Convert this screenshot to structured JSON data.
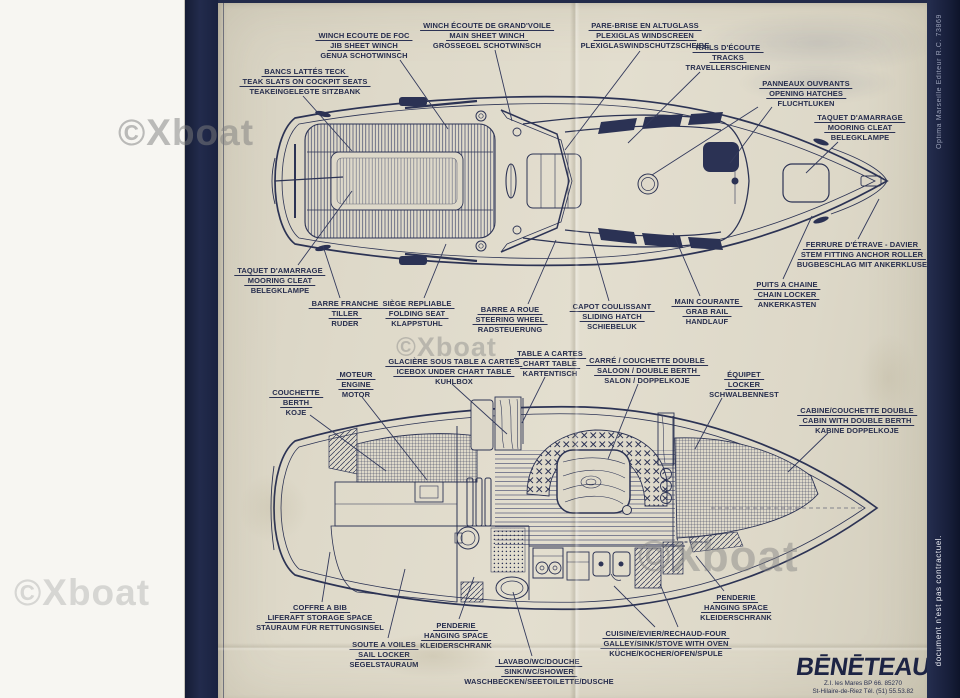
{
  "watermark": {
    "text": "©Xboat"
  },
  "edge": {
    "printer_credit": "Optima Marseille Editeur R.C. 73869",
    "disclaimer": "document n'est pas contractuel."
  },
  "logo": {
    "name": "BĒNĒTEAU",
    "address_line1": "Z.I. les Mares BP 66. 85270",
    "address_line2": "St-Hilaire-de-Riez Tél. (51) 55.53.82"
  },
  "deck_plan": {
    "callouts": [
      {
        "id": "jib-sheet-winch",
        "cx": 364,
        "top": 28,
        "fr": "WINCH ECOUTE DE FOC",
        "en": "JIB SHEET WINCH",
        "de": "GENUA SCHOTWINSCH",
        "leaders": [
          [
            400,
            57,
            448,
            126
          ]
        ]
      },
      {
        "id": "main-sheet-winch",
        "cx": 487,
        "top": 18,
        "fr": "WINCH ÉCOUTE DE GRAND'VOILE",
        "en": "MAIN SHEET WINCH",
        "de": "GROSSEGEL SCHOTWINSCH",
        "leaders": [
          [
            495,
            47,
            512,
            118
          ]
        ]
      },
      {
        "id": "windscreen",
        "cx": 645,
        "top": 18,
        "fr": "PARE-BRISE EN ALTUGLASS",
        "en": "PLEXIGLAS WINDSCREEN",
        "de": "PLEXIGLASWINDSCHUTZSCHEIBE",
        "leaders": [
          [
            640,
            48,
            565,
            147
          ]
        ]
      },
      {
        "id": "tracks",
        "cx": 728,
        "top": 40,
        "fr": "RAILS D'ÉCOUTE",
        "en": "TRACKS",
        "de": "TRAVELLERSCHIENEN",
        "leaders": [
          [
            700,
            69,
            628,
            140
          ]
        ]
      },
      {
        "id": "teak-slats",
        "cx": 305,
        "top": 64,
        "fr": "BANCS LATTÉS TECK",
        "en": "TEAK SLATS ON COCKPIT SEATS",
        "de": "TEAKEINGELEGTE SITZBANK",
        "leaders": [
          [
            303,
            93,
            352,
            148
          ]
        ]
      },
      {
        "id": "opening-hatches",
        "cx": 806,
        "top": 76,
        "fr": "PANNEAUX OUVRANTS",
        "en": "OPENING HATCHES",
        "de": "FLUCHTLUKEN",
        "leaders": [
          [
            772,
            104,
            730,
            160
          ],
          [
            758,
            104,
            652,
            172
          ]
        ]
      },
      {
        "id": "mooring-cleat-fwd",
        "cx": 860,
        "top": 110,
        "fr": "TAQUET D'AMARRAGE",
        "en": "MOORING CLEAT",
        "de": "BELEGKLAMPE",
        "leaders": [
          [
            838,
            139,
            806,
            170
          ]
        ]
      },
      {
        "id": "stem-fitting",
        "cx": 862,
        "top": 237,
        "fr": "FERRURE D'ÉTRAVE - DAVIER",
        "en": "STEM FITTING ANCHOR ROLLER",
        "de": "BUGBESCHLAG MIT ANKERKLUSE",
        "leaders": [
          [
            858,
            236,
            879,
            196
          ]
        ]
      },
      {
        "id": "chain-locker",
        "cx": 787,
        "top": 277,
        "fr": "PUITS A CHAINE",
        "en": "CHAIN LOCKER",
        "de": "ANKERKASTEN",
        "leaders": [
          [
            783,
            276,
            812,
            213
          ]
        ]
      },
      {
        "id": "grab-rail",
        "cx": 707,
        "top": 294,
        "fr": "MAIN COURANTE",
        "en": "GRAB RAIL",
        "de": "HANDLAUF",
        "leaders": [
          [
            700,
            293,
            673,
            230
          ]
        ]
      },
      {
        "id": "sliding-hatch",
        "cx": 612,
        "top": 299,
        "fr": "CAPOT COULISSANT",
        "en": "SLIDING HATCH",
        "de": "SCHIEBELUK",
        "leaders": [
          [
            609,
            298,
            589,
            230
          ]
        ]
      },
      {
        "id": "steering-wheel",
        "cx": 510,
        "top": 302,
        "fr": "BARRE A ROUE",
        "en": "STEERING WHEEL",
        "de": "RADSTEUERUNG",
        "leaders": [
          [
            528,
            301,
            556,
            237
          ]
        ]
      },
      {
        "id": "folding-seat",
        "cx": 417,
        "top": 296,
        "fr": "SIÈGE REPLIABLE",
        "en": "FOLDING SEAT",
        "de": "KLAPPSTUHL",
        "leaders": [
          [
            424,
            295,
            446,
            241
          ]
        ]
      },
      {
        "id": "tiller",
        "cx": 345,
        "top": 296,
        "fr": "BARRE FRANCHE",
        "en": "TILLER",
        "de": "RUDER",
        "leaders": [
          [
            340,
            295,
            323,
            243
          ]
        ]
      },
      {
        "id": "mooring-cleat-aft",
        "cx": 280,
        "top": 263,
        "fr": "TAQUET D'AMARRAGE",
        "en": "MOORING CLEAT",
        "de": "BELEGKLAMPE",
        "leaders": [
          [
            298,
            262,
            352,
            188
          ]
        ]
      }
    ]
  },
  "interior_plan": {
    "callouts": [
      {
        "id": "engine",
        "cx": 356,
        "top": 367,
        "fr": "MOTEUR",
        "en": "ENGINE",
        "de": "MOTOR",
        "leaders": [
          [
            362,
            394,
            427,
            477
          ]
        ]
      },
      {
        "id": "icebox",
        "cx": 454,
        "top": 354,
        "fr": "GLACIÈRE SOUS TABLE A CARTES",
        "en": "ICEBOX UNDER CHART TABLE",
        "de": "KUHLBOX",
        "leaders": [
          [
            452,
            381,
            507,
            431
          ]
        ]
      },
      {
        "id": "chart-table",
        "cx": 550,
        "top": 346,
        "fr": "TABLE A CARTES",
        "en": "CHART TABLE",
        "de": "KARTENTISCH",
        "leaders": [
          [
            545,
            374,
            522,
            420
          ]
        ]
      },
      {
        "id": "saloon-double-berth",
        "cx": 647,
        "top": 353,
        "fr": "CARRÉ / COUCHETTE DOUBLE",
        "en": "SALOON / DOUBLE BERTH",
        "de": "SALON / DOPPELKOJE",
        "leaders": [
          [
            638,
            381,
            608,
            456
          ]
        ]
      },
      {
        "id": "berth",
        "cx": 296,
        "top": 385,
        "fr": "COUCHETTE",
        "en": "BERTH",
        "de": "KOJE",
        "leaders": [
          [
            310,
            412,
            386,
            468
          ]
        ]
      },
      {
        "id": "locker",
        "cx": 744,
        "top": 367,
        "fr": "ÉQUIPET",
        "en": "LOCKER",
        "de": "SCHWALBENNEST",
        "leaders": [
          [
            722,
            395,
            695,
            446
          ]
        ]
      },
      {
        "id": "cabin-double-berth",
        "cx": 857,
        "top": 403,
        "fr": "CABINE/COUCHETTE DOUBLE",
        "en": "CABIN WITH DOUBLE BERTH",
        "de": "KABINE DOPPELKOJE",
        "leaders": [
          [
            828,
            430,
            788,
            469
          ]
        ]
      },
      {
        "id": "liferaft-storage",
        "cx": 320,
        "top": 600,
        "fr": "COFFRE A BIB",
        "en": "LIFERAFT STORAGE SPACE",
        "de": "STAURAUM FÜR RETTUNGSINSEL",
        "leaders": [
          [
            322,
            599,
            330,
            549
          ]
        ]
      },
      {
        "id": "sail-locker",
        "cx": 384,
        "top": 637,
        "fr": "SOUTE A VOILES",
        "en": "SAIL LOCKER",
        "de": "SEGELSTAURAUM",
        "leaders": [
          [
            388,
            635,
            405,
            566
          ]
        ]
      },
      {
        "id": "hanging-space-aft",
        "cx": 456,
        "top": 618,
        "fr": "PENDERIE",
        "en": "HANGING SPACE",
        "de": "KLEIDERSCHRANK",
        "leaders": [
          [
            459,
            616,
            474,
            574
          ]
        ]
      },
      {
        "id": "sink-wc-shower",
        "cx": 539,
        "top": 654,
        "fr": "LAVABO/WC/DOUCHE",
        "en": "SINK/WC/SHOWER",
        "de": "WASCHBECKEN/SEETOILETTE/DUSCHE",
        "leaders": [
          [
            532,
            653,
            513,
            589
          ]
        ]
      },
      {
        "id": "galley",
        "cx": 666,
        "top": 626,
        "fr": "CUISINE/EVIER/RECHAUD-FOUR",
        "en": "GALLEY/SINK/STOVE WITH OVEN",
        "de": "KÜCHE/KOCHER/OFEN/SPULE",
        "leaders": [
          [
            655,
            624,
            614,
            583
          ],
          [
            678,
            624,
            660,
            581
          ]
        ]
      },
      {
        "id": "hanging-space-fwd",
        "cx": 736,
        "top": 590,
        "fr": "PENDERIE",
        "en": "HANGING SPACE",
        "de": "KLEIDERSCHRANK",
        "leaders": [
          [
            724,
            588,
            696,
            553
          ]
        ]
      }
    ]
  }
}
